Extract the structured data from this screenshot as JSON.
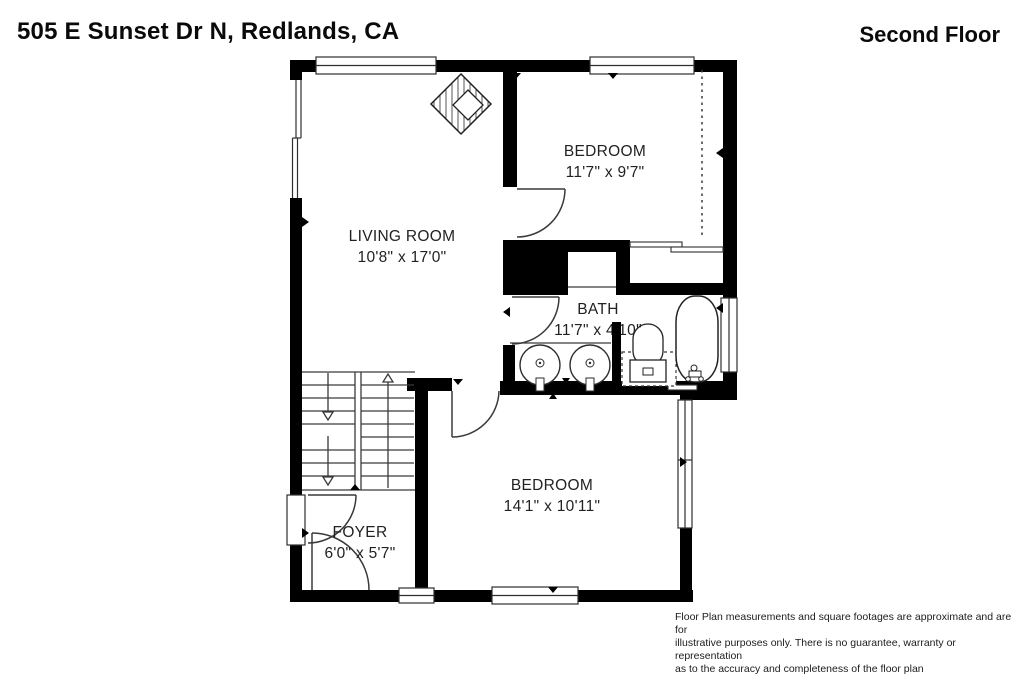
{
  "title": {
    "address": "505 E Sunset Dr N, Redlands, CA",
    "floor": "Second Floor"
  },
  "rooms": [
    {
      "id": "living-room",
      "name": "LIVING ROOM",
      "dims": "10'8\" x 17'0\""
    },
    {
      "id": "bedroom-top",
      "name": "BEDROOM",
      "dims": "11'7\" x 9'7\""
    },
    {
      "id": "bath",
      "name": "BATH",
      "dims": "11'7\" x 4'10\""
    },
    {
      "id": "bedroom-bottom",
      "name": "BEDROOM",
      "dims": "14'1\" x 10'11\""
    },
    {
      "id": "foyer",
      "name": "FOYER",
      "dims": "6'0\" x 5'7\""
    }
  ],
  "disclaimer": {
    "lines": [
      "Floor Plan measurements and square footages are approximate and are for",
      "illustrative purposes only. There is no guarantee, warranty or representation",
      "as to the accuracy and completeness of the floor plan"
    ]
  },
  "colors": {
    "wall": "#000000",
    "line": "#3a3a3a",
    "text": "#1f1f1f",
    "background": "#ffffff"
  }
}
